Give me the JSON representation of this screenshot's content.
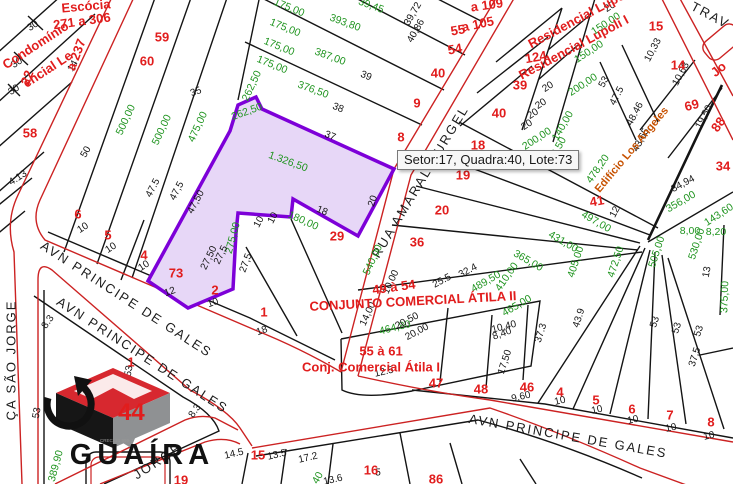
{
  "tooltip": {
    "text": "Setor:17, Quadra:40, Lote:73"
  },
  "selected_lot": {
    "setor": "17",
    "quadra": "40",
    "lote": "73",
    "area": "1.326,50"
  },
  "logo": {
    "brand": "GUAÍRA",
    "number": "44",
    "creci": "CRECI 21 999-J"
  },
  "map": {
    "labels": [
      {
        "t": "AVN PRINCIPE DE GALES",
        "x": 126,
        "y": 300,
        "r": 33,
        "c": "s"
      },
      {
        "t": "AVN PRINCIPE DE GALES",
        "x": 142,
        "y": 356,
        "r": 33,
        "c": "s"
      },
      {
        "t": "AVN  PRINCIPE DE GALES",
        "x": 568,
        "y": 437,
        "r": 10,
        "c": "s",
        "ls": 3
      },
      {
        "t": "RUA AMARAL GURGEL",
        "x": 421,
        "y": 182,
        "r": -59,
        "c": "s"
      },
      {
        "t": "ÇA SÃO JORGE",
        "x": 12,
        "y": 360,
        "r": -90,
        "c": "s"
      },
      {
        "t": "JORGE",
        "x": 158,
        "y": 462,
        "r": -33,
        "c": "s"
      },
      {
        "t": "TRAV",
        "x": 710,
        "y": 16,
        "r": 28,
        "c": "s"
      },
      {
        "t": "1.326,50",
        "x": 288,
        "y": 162,
        "r": 20,
        "c": "g",
        "fs": 13
      },
      {
        "t": "500,00",
        "x": 126,
        "y": 120,
        "r": -65,
        "c": "g"
      },
      {
        "t": "500,00",
        "x": 162,
        "y": 130,
        "r": -65,
        "c": "g"
      },
      {
        "t": "475,00",
        "x": 198,
        "y": 127,
        "r": -65,
        "c": "g"
      },
      {
        "t": "262,50",
        "x": 252,
        "y": 86,
        "r": -65,
        "c": "g"
      },
      {
        "t": "262,50",
        "x": 247,
        "y": 112,
        "r": -20,
        "c": "g",
        "fs": 9.5
      },
      {
        "t": "275,00",
        "x": 233,
        "y": 238,
        "r": -75,
        "c": "g"
      },
      {
        "t": "540,00",
        "x": 373,
        "y": 260,
        "r": -65,
        "c": "g"
      },
      {
        "t": "180,00",
        "x": 303,
        "y": 221,
        "r": 24,
        "c": "g"
      },
      {
        "t": "393,80",
        "x": 345,
        "y": 23,
        "r": 20,
        "c": "g"
      },
      {
        "t": "387,00",
        "x": 330,
        "y": 57,
        "r": 20,
        "c": "g"
      },
      {
        "t": "376,50",
        "x": 313,
        "y": 90,
        "r": 20,
        "c": "g"
      },
      {
        "t": "39,45",
        "x": 371,
        "y": 6,
        "r": 20,
        "c": "g",
        "fs": 10
      },
      {
        "t": "175,00",
        "x": 289,
        "y": 8,
        "r": 22,
        "c": "g",
        "fs": 9.5
      },
      {
        "t": "175,00",
        "x": 285,
        "y": 28,
        "r": 22,
        "c": "g",
        "fs": 9.5
      },
      {
        "t": "175,00",
        "x": 279,
        "y": 47,
        "r": 22,
        "c": "g",
        "fs": 9.5
      },
      {
        "t": "175,00",
        "x": 272,
        "y": 65,
        "r": 22,
        "c": "g",
        "fs": 9.5
      },
      {
        "t": "150,00",
        "x": 606,
        "y": 24,
        "r": -33,
        "c": "g"
      },
      {
        "t": "150,00",
        "x": 589,
        "y": 52,
        "r": -33,
        "c": "g"
      },
      {
        "t": "200,00",
        "x": 583,
        "y": 85,
        "r": -33,
        "c": "g"
      },
      {
        "t": "140,00",
        "x": 563,
        "y": 126,
        "r": -60,
        "c": "g"
      },
      {
        "t": "200,00",
        "x": 537,
        "y": 139,
        "r": -33,
        "c": "g",
        "fs": 9.5
      },
      {
        "t": "464,80",
        "x": 395,
        "y": 328,
        "r": -14,
        "c": "g"
      },
      {
        "t": "489,50",
        "x": 486,
        "y": 282,
        "r": -30,
        "c": "g"
      },
      {
        "t": "465,00",
        "x": 517,
        "y": 306,
        "r": -30,
        "c": "g"
      },
      {
        "t": "410,00",
        "x": 507,
        "y": 277,
        "r": -55,
        "c": "g"
      },
      {
        "t": "478,20",
        "x": 598,
        "y": 169,
        "r": -55,
        "c": "g"
      },
      {
        "t": "402,50",
        "x": 556,
        "y": 152,
        "r": -60,
        "c": "g",
        "fs": 9.5
      },
      {
        "t": "497,00",
        "x": 596,
        "y": 222,
        "r": 30,
        "c": "g"
      },
      {
        "t": "431,00",
        "x": 563,
        "y": 242,
        "r": 30,
        "c": "g"
      },
      {
        "t": "365,00",
        "x": 528,
        "y": 261,
        "r": 30,
        "c": "g"
      },
      {
        "t": "405,00",
        "x": 576,
        "y": 262,
        "r": -72,
        "c": "g"
      },
      {
        "t": "472,50",
        "x": 616,
        "y": 262,
        "r": -72,
        "c": "g"
      },
      {
        "t": "505,00",
        "x": 657,
        "y": 252,
        "r": -72,
        "c": "g"
      },
      {
        "t": "530,00",
        "x": 697,
        "y": 244,
        "r": -72,
        "c": "g"
      },
      {
        "t": "356,00",
        "x": 681,
        "y": 202,
        "r": -30,
        "c": "g"
      },
      {
        "t": "8,00",
        "x": 690,
        "y": 231,
        "c": "g",
        "fs": 9.5
      },
      {
        "t": "8,20",
        "x": 716,
        "y": 232,
        "c": "g",
        "fs": 9.5
      },
      {
        "t": "143,60",
        "x": 719,
        "y": 215,
        "r": -33,
        "c": "g",
        "fs": 9
      },
      {
        "t": "375,00",
        "x": 725,
        "y": 297,
        "r": -88,
        "c": "g"
      },
      {
        "t": "389,90",
        "x": 56,
        "y": 466,
        "r": -75,
        "c": "g"
      },
      {
        "t": "40",
        "x": 318,
        "y": 478,
        "r": -60,
        "c": "g",
        "fs": 9.5
      },
      {
        "t": "30",
        "x": 33,
        "y": 26,
        "r": -33
      },
      {
        "t": "30",
        "x": 17,
        "y": 63,
        "r": -33
      },
      {
        "t": "30",
        "x": 14,
        "y": 90,
        "r": -33
      },
      {
        "t": "4.13",
        "x": 18,
        "y": 178,
        "r": -33,
        "fs": 9.5
      },
      {
        "t": "14",
        "x": 73,
        "y": 66,
        "r": -60,
        "fs": 9.5
      },
      {
        "t": "35",
        "x": 196,
        "y": 92,
        "r": -20
      },
      {
        "t": "50",
        "x": 86,
        "y": 152,
        "r": -60
      },
      {
        "t": "47.5",
        "x": 153,
        "y": 188,
        "r": -62
      },
      {
        "t": "47,5",
        "x": 177,
        "y": 191,
        "r": -62
      },
      {
        "t": "47,50",
        "x": 196,
        "y": 202,
        "r": -62
      },
      {
        "t": "27,50",
        "x": 209,
        "y": 258,
        "r": -64
      },
      {
        "t": "27,5",
        "x": 221,
        "y": 255,
        "r": -64
      },
      {
        "t": "27,5",
        "x": 246,
        "y": 263,
        "r": -70
      },
      {
        "t": "12",
        "x": 170,
        "y": 292,
        "r": -20
      },
      {
        "t": "10",
        "x": 83,
        "y": 228,
        "r": -33
      },
      {
        "t": "10",
        "x": 111,
        "y": 248,
        "r": -33
      },
      {
        "t": "10",
        "x": 144,
        "y": 266,
        "r": -33
      },
      {
        "t": "10",
        "x": 213,
        "y": 303,
        "r": -20
      },
      {
        "t": "18",
        "x": 262,
        "y": 331,
        "r": -20
      },
      {
        "t": "10",
        "x": 259,
        "y": 222,
        "r": -62
      },
      {
        "t": "10",
        "x": 273,
        "y": 218,
        "r": -62
      },
      {
        "t": "18",
        "x": 322,
        "y": 211,
        "r": 22
      },
      {
        "t": "20",
        "x": 373,
        "y": 201,
        "r": -72
      },
      {
        "t": "37",
        "x": 330,
        "y": 136,
        "r": 22
      },
      {
        "t": "38",
        "x": 338,
        "y": 108,
        "r": 22
      },
      {
        "t": "39",
        "x": 366,
        "y": 76,
        "r": 22
      },
      {
        "t": "39,72",
        "x": 413,
        "y": 14,
        "r": -60,
        "fs": 8.5
      },
      {
        "t": "40,86",
        "x": 416,
        "y": 31,
        "r": -60,
        "fs": 8.5
      },
      {
        "t": "20",
        "x": 610,
        "y": 7,
        "r": -33,
        "fs": 9.5
      },
      {
        "t": "20",
        "x": 548,
        "y": 87,
        "r": -33,
        "fs": 9.5
      },
      {
        "t": "20",
        "x": 541,
        "y": 104,
        "r": -33,
        "fs": 9.5
      },
      {
        "t": "20",
        "x": 533,
        "y": 114,
        "r": -33,
        "fs": 9.5
      },
      {
        "t": "20",
        "x": 527,
        "y": 125,
        "r": -33,
        "fs": 9.5
      },
      {
        "t": "53",
        "x": 604,
        "y": 82,
        "r": -62
      },
      {
        "t": "47.5",
        "x": 617,
        "y": 96,
        "r": -62
      },
      {
        "t": "48.46",
        "x": 635,
        "y": 114,
        "r": -62
      },
      {
        "t": "43,65",
        "x": 641,
        "y": 140,
        "r": -62
      },
      {
        "t": "10,33",
        "x": 653,
        "y": 50,
        "r": -62,
        "fs": 9
      },
      {
        "t": "10,63",
        "x": 681,
        "y": 74,
        "r": -62,
        "fs": 9
      },
      {
        "t": "19,50",
        "x": 704,
        "y": 117,
        "r": -62,
        "fs": 9
      },
      {
        "t": "34,94",
        "x": 683,
        "y": 184,
        "r": -28
      },
      {
        "t": "13",
        "x": 707,
        "y": 272,
        "r": -80,
        "fs": 9.5
      },
      {
        "t": "12",
        "x": 615,
        "y": 212,
        "r": -62,
        "fs": 9.5
      },
      {
        "t": "25.5",
        "x": 442,
        "y": 281,
        "r": -28
      },
      {
        "t": "32.4",
        "x": 468,
        "y": 271,
        "r": -28
      },
      {
        "t": "10,00",
        "x": 391,
        "y": 282,
        "r": -65,
        "fs": 9.5
      },
      {
        "t": "14,00",
        "x": 368,
        "y": 314,
        "r": -65
      },
      {
        "t": "20,50",
        "x": 407,
        "y": 321,
        "r": -28
      },
      {
        "t": "20,00",
        "x": 417,
        "y": 332,
        "r": -28
      },
      {
        "t": "12.5",
        "x": 384,
        "y": 372,
        "r": -13
      },
      {
        "t": "10,40",
        "x": 504,
        "y": 327,
        "r": -14,
        "fs": 9.5
      },
      {
        "t": "9,60",
        "x": 521,
        "y": 397,
        "r": -13
      },
      {
        "t": "10",
        "x": 560,
        "y": 401,
        "r": -13,
        "fs": 9.5
      },
      {
        "t": "10",
        "x": 597,
        "y": 410,
        "r": -13,
        "fs": 9.5
      },
      {
        "t": "10",
        "x": 633,
        "y": 420,
        "r": -13,
        "fs": 9.5
      },
      {
        "t": "10",
        "x": 671,
        "y": 428,
        "r": -13,
        "fs": 9.5
      },
      {
        "t": "10",
        "x": 709,
        "y": 436,
        "r": -13,
        "fs": 9.5
      },
      {
        "t": "43.9",
        "x": 579,
        "y": 318,
        "r": -72
      },
      {
        "t": "37.3",
        "x": 541,
        "y": 333,
        "r": -72
      },
      {
        "t": "53",
        "x": 655,
        "y": 322,
        "r": -72
      },
      {
        "t": "53",
        "x": 677,
        "y": 328,
        "r": -72
      },
      {
        "t": "53",
        "x": 699,
        "y": 331,
        "r": -72
      },
      {
        "t": "37,5",
        "x": 695,
        "y": 357,
        "r": -72
      },
      {
        "t": "17,50",
        "x": 505,
        "y": 362,
        "r": -72
      },
      {
        "t": "8,40",
        "x": 502,
        "y": 334,
        "r": -20,
        "fs": 9.5
      },
      {
        "t": "14.5",
        "x": 234,
        "y": 454,
        "r": -13
      },
      {
        "t": "13.5",
        "x": 277,
        "y": 455,
        "r": -13
      },
      {
        "t": "17.2",
        "x": 308,
        "y": 458,
        "r": -13
      },
      {
        "t": "13.6",
        "x": 333,
        "y": 480,
        "r": -13,
        "fs": 9
      },
      {
        "t": "5",
        "x": 378,
        "y": 473,
        "fs": 9.5
      },
      {
        "t": "53",
        "x": 129,
        "y": 371,
        "r": -80
      },
      {
        "t": "53",
        "x": 37,
        "y": 413,
        "r": -80
      },
      {
        "t": "8.3",
        "x": 195,
        "y": 411,
        "r": -55,
        "fs": 9.5
      },
      {
        "t": "8.3",
        "x": 48,
        "y": 322,
        "r": -55,
        "fs": 9.5
      },
      {
        "t": "Escócia",
        "x": 86,
        "y": 7,
        "r": -5,
        "c": "r",
        "fs": 14
      },
      {
        "t": "271 a 306",
        "x": 82,
        "y": 22,
        "r": -8,
        "c": "r"
      },
      {
        "t": "Condomínio",
        "x": 36,
        "y": 46,
        "r": -33,
        "c": "r",
        "fs": 12
      },
      {
        "t": "encial Le",
        "x": 48,
        "y": 70,
        "r": -33,
        "c": "r",
        "fs": 11
      },
      {
        "t": "a 237",
        "x": 77,
        "y": 55,
        "r": -70,
        "c": "r"
      },
      {
        "t": "22",
        "x": 28,
        "y": 78,
        "r": -70,
        "c": "r",
        "fs": 16
      },
      {
        "t": "58",
        "x": 30,
        "y": 134,
        "c": "r",
        "fs": 15
      },
      {
        "t": "59",
        "x": 162,
        "y": 38,
        "c": "r",
        "fs": 15
      },
      {
        "t": "60",
        "x": 147,
        "y": 62,
        "c": "r",
        "fs": 15
      },
      {
        "t": "6",
        "x": 78,
        "y": 215,
        "c": "r",
        "fs": 15
      },
      {
        "t": "5",
        "x": 108,
        "y": 236,
        "c": "r",
        "fs": 15
      },
      {
        "t": "4",
        "x": 144,
        "y": 256,
        "c": "r",
        "fs": 15
      },
      {
        "t": "73",
        "x": 176,
        "y": 274,
        "c": "r",
        "fs": 17
      },
      {
        "t": "2",
        "x": 215,
        "y": 291,
        "c": "r",
        "fs": 15
      },
      {
        "t": "1",
        "x": 264,
        "y": 313,
        "c": "r",
        "fs": 15
      },
      {
        "t": "29",
        "x": 337,
        "y": 237,
        "c": "r",
        "fs": 15
      },
      {
        "t": "40",
        "x": 438,
        "y": 74,
        "c": "r",
        "fs": 15
      },
      {
        "t": "9",
        "x": 417,
        "y": 104,
        "c": "r",
        "fs": 14
      },
      {
        "t": "8",
        "x": 401,
        "y": 138,
        "c": "r",
        "fs": 14
      },
      {
        "t": "55",
        "x": 458,
        "y": 31,
        "r": -10,
        "c": "r"
      },
      {
        "t": "54",
        "x": 455,
        "y": 50,
        "r": -10,
        "c": "r"
      },
      {
        "t": "a 109",
        "x": 487,
        "y": 6,
        "r": -8,
        "c": "r",
        "fs": 12
      },
      {
        "t": "a 105",
        "x": 478,
        "y": 25,
        "r": -12,
        "c": "r",
        "fs": 12
      },
      {
        "t": "124",
        "x": 536,
        "y": 58,
        "r": -10,
        "c": "r"
      },
      {
        "t": "39",
        "x": 520,
        "y": 86,
        "c": "r",
        "fs": 15
      },
      {
        "t": "40",
        "x": 499,
        "y": 114,
        "c": "r",
        "fs": 15
      },
      {
        "t": "15",
        "x": 656,
        "y": 27,
        "c": "r",
        "fs": 15
      },
      {
        "t": "14",
        "x": 678,
        "y": 66,
        "c": "r",
        "fs": 15
      },
      {
        "t": "69",
        "x": 692,
        "y": 106,
        "r": -15,
        "c": "r",
        "fs": 15
      },
      {
        "t": "88",
        "x": 719,
        "y": 125,
        "r": -55,
        "c": "r",
        "fs": 15
      },
      {
        "t": "34",
        "x": 723,
        "y": 167,
        "c": "r",
        "fs": 14
      },
      {
        "t": "41",
        "x": 597,
        "y": 202,
        "r": -10,
        "c": "r"
      },
      {
        "t": "18",
        "x": 478,
        "y": 146,
        "c": "r"
      },
      {
        "t": "19",
        "x": 463,
        "y": 176,
        "c": "r"
      },
      {
        "t": "20",
        "x": 442,
        "y": 211,
        "c": "r"
      },
      {
        "t": "36",
        "x": 417,
        "y": 243,
        "c": "r",
        "fs": 14
      },
      {
        "t": "49 à 54",
        "x": 394,
        "y": 288,
        "r": -8,
        "c": "r"
      },
      {
        "t": "CONJUNTO COMERCIAL ÁTILA II",
        "x": 413,
        "y": 302,
        "r": -3,
        "c": "r",
        "fs": 12
      },
      {
        "t": "55 à 61",
        "x": 381,
        "y": 352,
        "c": "r",
        "fs": 14
      },
      {
        "t": "Conj. Comercial Átila I",
        "x": 371,
        "y": 368,
        "c": "r",
        "fs": 12
      },
      {
        "t": "47",
        "x": 436,
        "y": 384,
        "c": "r"
      },
      {
        "t": "48",
        "x": 481,
        "y": 390,
        "c": "r"
      },
      {
        "t": "46",
        "x": 527,
        "y": 388,
        "c": "r",
        "fs": 15
      },
      {
        "t": "4",
        "x": 560,
        "y": 393,
        "c": "r",
        "fs": 14
      },
      {
        "t": "5",
        "x": 596,
        "y": 401,
        "c": "r",
        "fs": 14
      },
      {
        "t": "6",
        "x": 632,
        "y": 410,
        "c": "r",
        "fs": 14
      },
      {
        "t": "7",
        "x": 670,
        "y": 416,
        "c": "r",
        "fs": 14
      },
      {
        "t": "8",
        "x": 711,
        "y": 423,
        "c": "r",
        "fs": 14
      },
      {
        "t": "15",
        "x": 258,
        "y": 456,
        "c": "r"
      },
      {
        "t": "16",
        "x": 371,
        "y": 471,
        "c": "r"
      },
      {
        "t": "86",
        "x": 436,
        "y": 480,
        "c": "r"
      },
      {
        "t": "19",
        "x": 181,
        "y": 481,
        "c": "r",
        "fs": 12
      },
      {
        "t": "1",
        "x": 131,
        "y": 363,
        "c": "r"
      },
      {
        "t": "Residencial Lupoli II",
        "x": 585,
        "y": 16,
        "r": -28,
        "c": "r",
        "fs": 10
      },
      {
        "t": "Residencial Lupoli I",
        "x": 574,
        "y": 48,
        "r": -28,
        "c": "r",
        "fs": 10
      },
      {
        "t": "Jo",
        "x": 719,
        "y": 70,
        "r": -40,
        "c": "r",
        "fs": 12
      },
      {
        "t": "Edifício Los Angeles",
        "x": 632,
        "y": 150,
        "r": -50,
        "c": "o"
      }
    ]
  }
}
